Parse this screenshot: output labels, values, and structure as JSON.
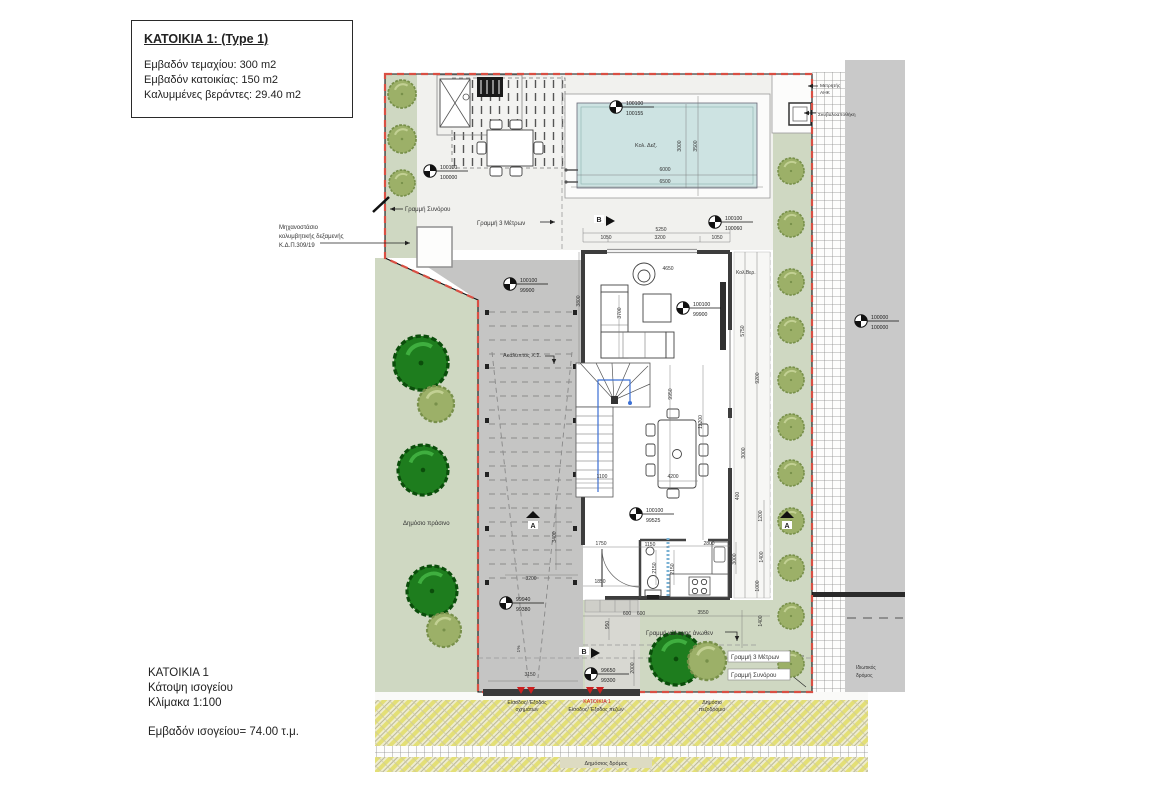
{
  "title_block": {
    "title": "ΚΑΤΟΙΚΙΑ 1: (Type 1)",
    "plot_area": "Εμβαδόν τεμαχίου: 300 m2",
    "house_area": "Εμβαδόν κατοικίας:  150 m2",
    "veranda_area": "Καλυμμένες βεράντες: 29.40 m2"
  },
  "footer_block": {
    "house": "ΚΑΤΟΙΚΙΑ 1",
    "view": "Κάτοψη ισογείου",
    "scale": "Κλίμακα 1:100",
    "area": "Εμβαδόν ισογείου= 74.00  τ.μ."
  },
  "colors": {
    "boundary_red": "#d94f43",
    "public_green": "#cfd8c2",
    "tree_dark": "#1e7d1e",
    "tree_olive": "#9cb068",
    "pool_water": "#cde3e2",
    "road_gray": "#c9c9c9",
    "carport_gray": "#c5c5c4",
    "road_yellow": "#e3df76",
    "wall_dark": "#3d3d3d",
    "stair_route_blue": "#3b6fd4",
    "entrance_red": "#cc2020"
  },
  "plan": {
    "labels": [
      {
        "text": "Γραμμή Συνόρου",
        "x": 405,
        "y": 211,
        "size": 6,
        "name": "label-boundary-line-top"
      },
      {
        "text": "Γραμμή 3 Μέτρων",
        "x": 477,
        "y": 225,
        "size": 6,
        "name": "label-3m-line-top"
      },
      {
        "text": "Μηχανοστάσιο",
        "x": 279,
        "y": 229,
        "size": 6,
        "name": "label-pump-room-line1"
      },
      {
        "text": "κολυμβητικής δεξαμενής",
        "x": 279,
        "y": 238,
        "size": 6,
        "name": "label-pump-room-line2"
      },
      {
        "text": "Κ.Δ.Π.309/19",
        "x": 279,
        "y": 247,
        "size": 6,
        "name": "label-pump-room-line3"
      },
      {
        "text": "Κολ. Δεξ.",
        "x": 635,
        "y": 147,
        "size": 5.5,
        "name": "label-pool"
      },
      {
        "text": "Κολ.Βερ.",
        "x": 736,
        "y": 274,
        "size": 5,
        "name": "label-covered-veranda"
      },
      {
        "text": "Ακάλυπτος Χ.Σ.",
        "x": 503,
        "y": 357,
        "size": 5.5,
        "name": "label-uncovered-parking"
      },
      {
        "text": "Δημόσιο πράσινο",
        "x": 403,
        "y": 525,
        "size": 6,
        "name": "label-public-green"
      },
      {
        "text": "Μετρητής",
        "x": 820,
        "y": 87,
        "size": 4.8,
        "name": "label-ahk-meter-line1"
      },
      {
        "text": "ΑΗΚ",
        "x": 820,
        "y": 94,
        "size": 4.8,
        "name": "label-ahk-meter-line2"
      },
      {
        "text": "Σκυβαλοαποθήκη",
        "x": 818,
        "y": 116,
        "size": 4.8,
        "name": "label-garbage-store"
      },
      {
        "text": "Ιδιωτικός",
        "x": 856,
        "y": 669,
        "size": 5,
        "name": "label-private-road-line1"
      },
      {
        "text": "δρόμος",
        "x": 856,
        "y": 677,
        "size": 5,
        "name": "label-private-road-line2"
      },
      {
        "text": "Γραμμή κάλυψης άνωθεν",
        "x": 646,
        "y": 635,
        "size": 6,
        "name": "label-coverage-line"
      },
      {
        "text": "Γραμμή 3 Μέτρων",
        "x": 731,
        "y": 659,
        "size": 6,
        "bg": [
          62,
          11
        ],
        "name": "label-3m-line-south"
      },
      {
        "text": "Γραμμή Συνόρου",
        "x": 731,
        "y": 677,
        "size": 6,
        "bg": [
          62,
          11
        ],
        "name": "label-boundary-line-south"
      },
      {
        "text": "Δημόσιο",
        "x": 712,
        "y": 704,
        "size": 5.2,
        "anchor": "middle",
        "name": "label-public-sidewalk-line1"
      },
      {
        "text": "πεζοδρόμιο",
        "x": 712,
        "y": 711,
        "size": 5.2,
        "anchor": "middle",
        "name": "label-public-sidewalk-line2"
      },
      {
        "text": "Είσοδος/ Έξοδος",
        "x": 527,
        "y": 704,
        "size": 5.2,
        "anchor": "middle",
        "name": "label-vehicle-entrance-line1"
      },
      {
        "text": "οχημάτων",
        "x": 527,
        "y": 711,
        "size": 5.2,
        "anchor": "middle",
        "name": "label-vehicle-entrance-line2"
      },
      {
        "text": "ΚΑΤΟΙΚΙΑ 1",
        "x": 597,
        "y": 703,
        "size": 5.2,
        "color": "#cc2020",
        "anchor": "middle",
        "name": "label-house-entrance-title"
      },
      {
        "text": "Είσοδος/ Έξοδος πεζών",
        "x": 596,
        "y": 711,
        "size": 5.2,
        "anchor": "middle",
        "name": "label-pedestrian-entrance"
      },
      {
        "text": "Δημόσιος δρόμος",
        "x": 606,
        "y": 765,
        "size": 5.5,
        "anchor": "middle",
        "name": "label-public-road"
      },
      {
        "text": "1%",
        "x": 520,
        "y": 649,
        "size": 4.8,
        "rot": -90,
        "anchor": "middle",
        "name": "label-ramp-slope"
      },
      {
        "text": "5250",
        "x": 661,
        "y": 231,
        "anchor": "middle",
        "name": "dim-label"
      },
      {
        "text": "1050",
        "x": 606,
        "y": 239,
        "anchor": "middle",
        "name": "dim-label"
      },
      {
        "text": "3200",
        "x": 660,
        "y": 239,
        "anchor": "middle",
        "name": "dim-label"
      },
      {
        "text": "1050",
        "x": 717,
        "y": 239,
        "anchor": "middle",
        "name": "dim-label"
      },
      {
        "text": "3000",
        "x": 681,
        "y": 146,
        "rot": -90,
        "anchor": "middle",
        "name": "dim-label"
      },
      {
        "text": "3500",
        "x": 697,
        "y": 146,
        "rot": -90,
        "anchor": "middle",
        "name": "dim-label"
      },
      {
        "text": "6000",
        "x": 665,
        "y": 171,
        "anchor": "middle",
        "name": "dim-label"
      },
      {
        "text": "6500",
        "x": 665,
        "y": 183,
        "anchor": "middle",
        "name": "dim-label"
      },
      {
        "text": "4650",
        "x": 668,
        "y": 270,
        "anchor": "middle",
        "name": "dim-label"
      },
      {
        "text": "3800",
        "x": 580,
        "y": 301,
        "rot": -90,
        "anchor": "middle",
        "name": "dim-label"
      },
      {
        "text": "3700",
        "x": 621,
        "y": 313,
        "rot": -90,
        "anchor": "middle",
        "name": "dim-label"
      },
      {
        "text": "5750",
        "x": 744,
        "y": 331,
        "rot": -90,
        "anchor": "middle",
        "name": "dim-label"
      },
      {
        "text": "9200",
        "x": 759,
        "y": 378,
        "rot": -90,
        "anchor": "middle",
        "name": "dim-label"
      },
      {
        "text": "9950",
        "x": 672,
        "y": 394,
        "rot": -90,
        "anchor": "middle",
        "name": "dim-label"
      },
      {
        "text": "12200",
        "x": 702,
        "y": 422,
        "rot": -90,
        "anchor": "middle",
        "name": "dim-label"
      },
      {
        "text": "3000",
        "x": 745,
        "y": 453,
        "rot": -90,
        "anchor": "middle",
        "name": "dim-label"
      },
      {
        "text": "400",
        "x": 739,
        "y": 496,
        "rot": -90,
        "anchor": "middle",
        "name": "dim-label"
      },
      {
        "text": "1200",
        "x": 762,
        "y": 516,
        "rot": -90,
        "anchor": "middle",
        "name": "dim-label"
      },
      {
        "text": "1400",
        "x": 763,
        "y": 557,
        "rot": -90,
        "anchor": "middle",
        "name": "dim-label"
      },
      {
        "text": "1000",
        "x": 759,
        "y": 586,
        "rot": -90,
        "anchor": "middle",
        "name": "dim-label"
      },
      {
        "text": "1100",
        "x": 602,
        "y": 478,
        "anchor": "middle",
        "name": "dim-label"
      },
      {
        "text": "4200",
        "x": 673,
        "y": 478,
        "anchor": "middle",
        "name": "dim-label"
      },
      {
        "text": "3400",
        "x": 556,
        "y": 537,
        "rot": -90,
        "anchor": "middle",
        "name": "dim-label"
      },
      {
        "text": "3200",
        "x": 531,
        "y": 580,
        "anchor": "middle",
        "name": "dim-label"
      },
      {
        "text": "3150",
        "x": 530,
        "y": 676,
        "anchor": "middle",
        "name": "dim-label"
      },
      {
        "text": "1750",
        "x": 601,
        "y": 545,
        "anchor": "middle",
        "name": "dim-label"
      },
      {
        "text": "1150",
        "x": 650,
        "y": 546,
        "anchor": "middle",
        "name": "dim-label"
      },
      {
        "text": "2800",
        "x": 709,
        "y": 545,
        "anchor": "middle",
        "name": "dim-label"
      },
      {
        "text": "1850",
        "x": 600,
        "y": 583,
        "anchor": "middle",
        "name": "dim-label"
      },
      {
        "text": "2150",
        "x": 656,
        "y": 568,
        "rot": -90,
        "anchor": "middle",
        "name": "dim-label"
      },
      {
        "text": "2150",
        "x": 674,
        "y": 569,
        "rot": -90,
        "anchor": "middle",
        "name": "dim-label"
      },
      {
        "text": "3000",
        "x": 736,
        "y": 559,
        "rot": -90,
        "anchor": "middle",
        "name": "dim-label"
      },
      {
        "text": "600",
        "x": 627,
        "y": 615,
        "anchor": "middle",
        "name": "dim-label"
      },
      {
        "text": "600",
        "x": 641,
        "y": 615,
        "anchor": "middle",
        "name": "dim-label"
      },
      {
        "text": "3550",
        "x": 703,
        "y": 614,
        "anchor": "middle",
        "name": "dim-label"
      },
      {
        "text": "950",
        "x": 609,
        "y": 625,
        "rot": -90,
        "anchor": "middle",
        "name": "dim-label"
      },
      {
        "text": "1400",
        "x": 762,
        "y": 621,
        "rot": -90,
        "anchor": "middle",
        "name": "dim-label"
      },
      {
        "text": "2000",
        "x": 634,
        "y": 668,
        "rot": -90,
        "anchor": "middle",
        "name": "dim-label"
      }
    ],
    "level_markers": [
      {
        "top": "100100",
        "bottom": "100000",
        "x": 430,
        "y": 171
      },
      {
        "top": "100100",
        "bottom": "100155",
        "x": 616,
        "y": 107
      },
      {
        "top": "100100",
        "bottom": "100060",
        "x": 715,
        "y": 222
      },
      {
        "top": "100100",
        "bottom": "99900",
        "x": 510,
        "y": 284
      },
      {
        "top": "100100",
        "bottom": "99900",
        "x": 683,
        "y": 308
      },
      {
        "top": "100100",
        "bottom": "99525",
        "x": 636,
        "y": 514
      },
      {
        "top": "99940",
        "bottom": "99380",
        "x": 506,
        "y": 603
      },
      {
        "top": "99650",
        "bottom": "99300",
        "x": 591,
        "y": 674
      },
      {
        "top": "100000",
        "bottom": "100000",
        "x": 861,
        "y": 321
      }
    ],
    "section_markers": [
      {
        "letter": "B",
        "x": 599,
        "y": 221,
        "dir": "right"
      },
      {
        "letter": "B",
        "x": 584,
        "y": 653,
        "dir": "right"
      },
      {
        "letter": "A",
        "x": 533,
        "y": 527,
        "dir": "up"
      },
      {
        "letter": "A",
        "x": 787,
        "y": 527,
        "dir": "up"
      }
    ],
    "trees": {
      "dark": [
        [
          421,
          363,
          27
        ],
        [
          423,
          470,
          25
        ],
        [
          432,
          591,
          25
        ],
        [
          676,
          659,
          26
        ]
      ],
      "olive": [
        [
          402,
          94,
          14
        ],
        [
          402,
          139,
          14
        ],
        [
          402,
          183,
          13
        ],
        [
          436,
          404,
          18
        ],
        [
          444,
          630,
          17
        ],
        [
          707,
          661,
          19
        ],
        [
          791,
          171,
          13
        ],
        [
          791,
          224,
          13
        ],
        [
          791,
          282,
          13
        ],
        [
          791,
          330,
          13
        ],
        [
          791,
          380,
          13
        ],
        [
          791,
          427,
          13
        ],
        [
          791,
          473,
          13
        ],
        [
          791,
          521,
          13
        ],
        [
          791,
          568,
          13
        ],
        [
          791,
          616,
          13
        ],
        [
          791,
          664,
          13
        ]
      ]
    }
  }
}
